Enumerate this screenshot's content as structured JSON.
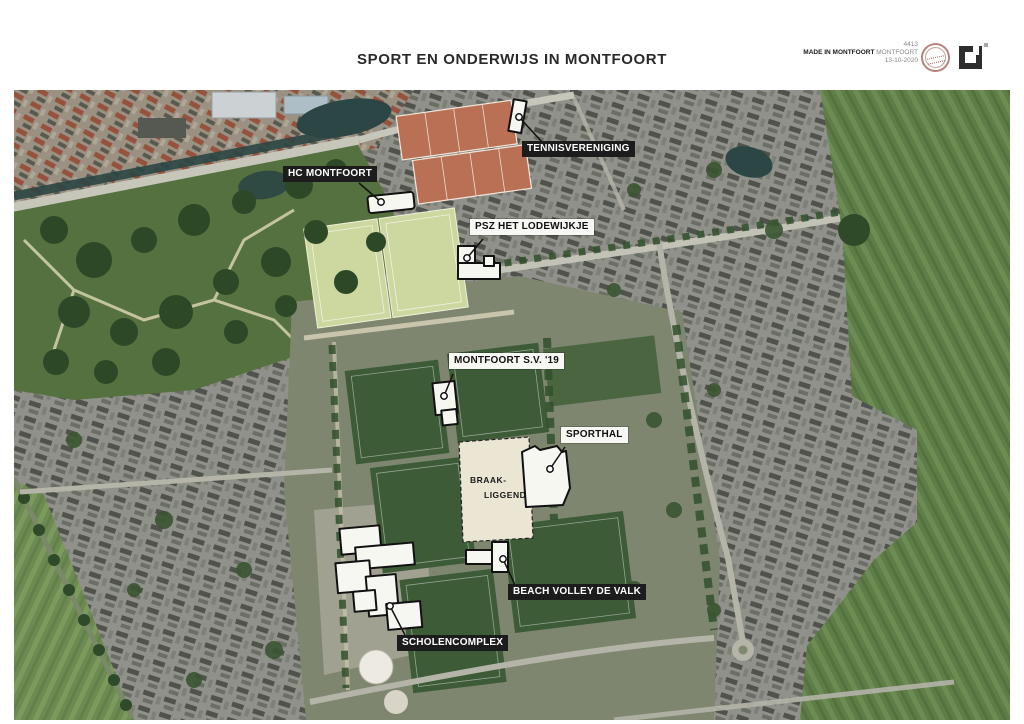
{
  "page": {
    "title": "SPORT EN ONDERWIJS IN MONTFOORT"
  },
  "stamp": {
    "number": "4413",
    "made_in_bold": "MADE IN MONTFOORT",
    "made_in_rest": "MONTFOORT",
    "date": "13-10-2020"
  },
  "map": {
    "labels": [
      {
        "id": "tennisvereniging",
        "text": "TENNISVERENIGING",
        "style": "dark"
      },
      {
        "id": "hc-montfoort",
        "text": "HC MONTFOORT",
        "style": "dark"
      },
      {
        "id": "psz-het-lodewijkje",
        "text": "PSZ HET LODEWIJKJE",
        "style": "light"
      },
      {
        "id": "montfoort-sv-19",
        "text": "MONTFOORT S.V. '19",
        "style": "light"
      },
      {
        "id": "sporthal",
        "text": "SPORTHAL",
        "style": "light"
      },
      {
        "id": "beach-volley-de-valk",
        "text": "BEACH VOLLEY DE VALK",
        "style": "dark"
      },
      {
        "id": "scholencomplex",
        "text": "SCHOLENCOMPLEX",
        "style": "dark"
      }
    ],
    "annotations": {
      "braak_line1": "BRAAK-",
      "braak_line2": "LIGGEND"
    },
    "colors": {
      "label_dark_bg": "#1c1c1c",
      "label_dark_text": "#ffffff",
      "label_light_bg": "#f7f7f3",
      "label_light_text": "#111111",
      "football_field": "#3d5b37",
      "hockey_field": "#cdd7a0",
      "tennis_clay": "#b97054",
      "farmland": "#5f7e47",
      "vacant_lot": "#eae6d3",
      "water": "#2b4644",
      "seal": "#9b5a52"
    }
  }
}
